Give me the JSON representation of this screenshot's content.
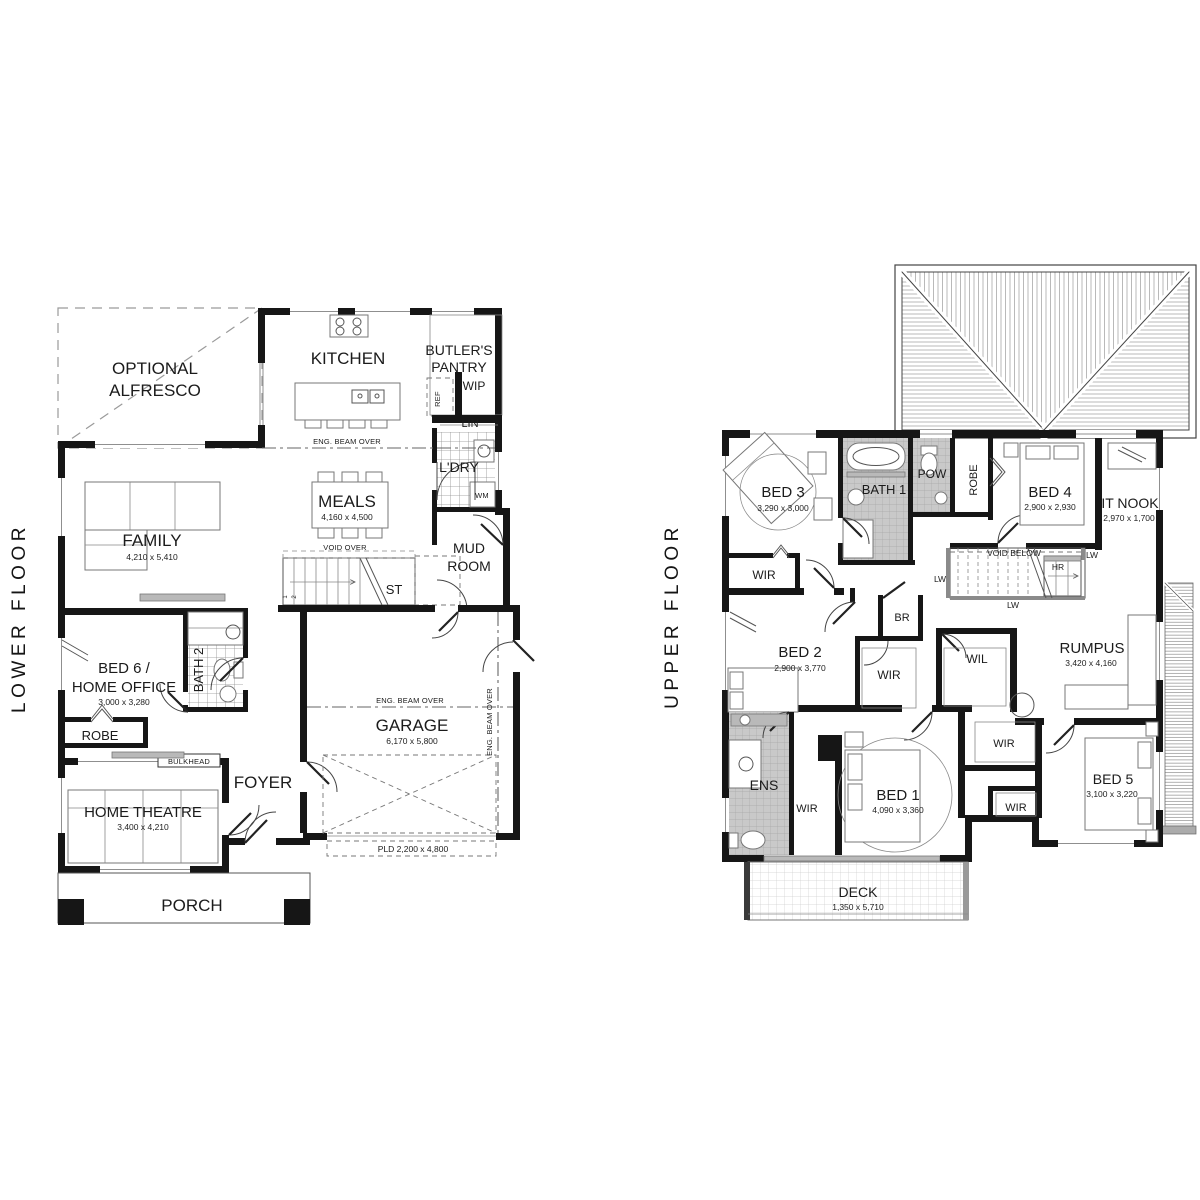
{
  "titles": {
    "lower": "LOWER FLOOR",
    "upper": "UPPER FLOOR"
  },
  "lower": {
    "alfresco1": "OPTIONAL",
    "alfresco2": "ALFRESCO",
    "kitchen": "KITCHEN",
    "butlers1": "BUTLER'S",
    "butlers2": "PANTRY",
    "wip": "WIP",
    "ref": "REF",
    "lin": "LIN",
    "ldry": "L'DRY",
    "wm": "WM",
    "beam_meals": "ENG. BEAM OVER",
    "meals": "MEALS",
    "meals_dim": "4,160 x 4,500",
    "family": "FAMILY",
    "family_dim": "4,210 x 5,410",
    "void_over": "VOID OVER",
    "st": "ST",
    "n1": "1",
    "n2": "2",
    "mud1": "MUD",
    "mud2": "ROOM",
    "bed6a": "BED 6 /",
    "bed6b": "HOME OFFICE",
    "bed6_dim": "3,000 x 3,280",
    "bath2": "BATH 2",
    "robe": "ROBE",
    "bulkhead": "BULKHEAD",
    "foyer": "FOYER",
    "theatre": "HOME THEATRE",
    "theatre_dim": "3,400 x 4,210",
    "garage": "GARAGE",
    "garage_dim": "6,170 x 5,800",
    "beam_garage": "ENG. BEAM OVER",
    "beam_garage_v": "ENG. BEAM OVER",
    "pld": "PLD 2,200 x 4,800",
    "porch": "PORCH"
  },
  "upper": {
    "bed3": "BED 3",
    "bed3_dim": "3,290 x 3,000",
    "bath1": "BATH 1",
    "pow": "POW",
    "robe": "ROBE",
    "bed4": "BED 4",
    "bed4_dim": "2,900 x 2,930",
    "itnook": "IT NOOK",
    "itnook_dim": "2,970 x 1,700",
    "wir_bed3": "WIR",
    "void_below": "VOID BELOW",
    "hr": "HR",
    "lw_left": "LW",
    "lw_right": "LW",
    "lw_bottom": "LW",
    "br": "BR",
    "bed2": "BED 2",
    "bed2_dim": "2,900 x 3,770",
    "wir_bed2": "WIR",
    "wil": "WIL",
    "rumpus": "RUMPUS",
    "rumpus_dim": "3,420 x 4,160",
    "ens": "ENS",
    "wir_bed1": "WIR",
    "bed1": "BED 1",
    "bed1_dim": "4,090 x 3,360",
    "wir_hall": "WIR",
    "wir_bed5": "WIR",
    "bed5": "BED 5",
    "bed5_dim": "3,100 x 3,220",
    "deck": "DECK",
    "deck_dim": "1,350 x 5,710"
  }
}
